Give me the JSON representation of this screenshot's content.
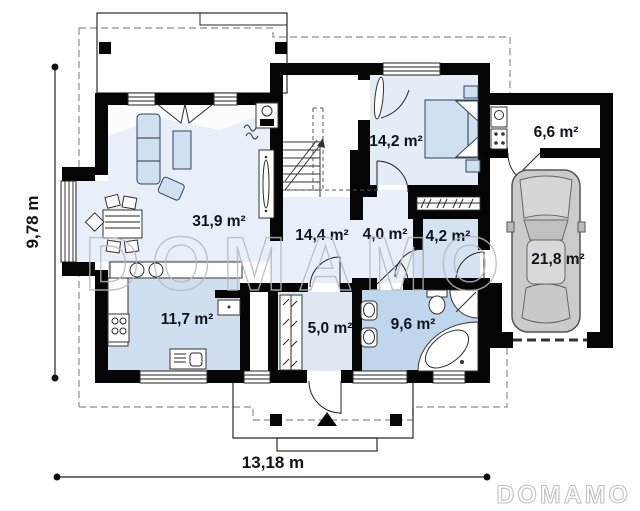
{
  "plan": {
    "title": "single-storey house floor plan",
    "rooms": [
      {
        "id": "living-room",
        "area_label": "31,9 m²"
      },
      {
        "id": "hall",
        "area_label": "14,4 m²"
      },
      {
        "id": "bedroom",
        "area_label": "14,2 m²"
      },
      {
        "id": "corridor",
        "area_label": "4,0 m²"
      },
      {
        "id": "wardrobe",
        "area_label": "4,2 m²"
      },
      {
        "id": "boiler-room",
        "area_label": "6,6 m²"
      },
      {
        "id": "garage",
        "area_label": "21,8 m²"
      },
      {
        "id": "kitchen",
        "area_label": "11,7 m²"
      },
      {
        "id": "vestibule",
        "area_label": "5,0 m²"
      },
      {
        "id": "bathroom",
        "area_label": "9,6 m²"
      }
    ],
    "dimensions": {
      "height_label": "9,78 m",
      "width_label": "13,18 m"
    },
    "watermark": {
      "center": "DOMAMO",
      "corner": "DOMAMO"
    },
    "colors": {
      "wall": "#050505",
      "floor_light": "#e9eff8",
      "floor_bedroom": "#e4ecf6",
      "floor_medium": "#d5e2f1",
      "floor_kitchen": "#cfdff0",
      "floor_bath": "#c0d6ec",
      "floor_vest": "#dfe9f4",
      "furniture": "#cfe0f1",
      "label_text": "#10131c",
      "watermark": "#b6bac1",
      "dash": "#9aa0a6",
      "car_body": "#cbcbcb"
    }
  }
}
